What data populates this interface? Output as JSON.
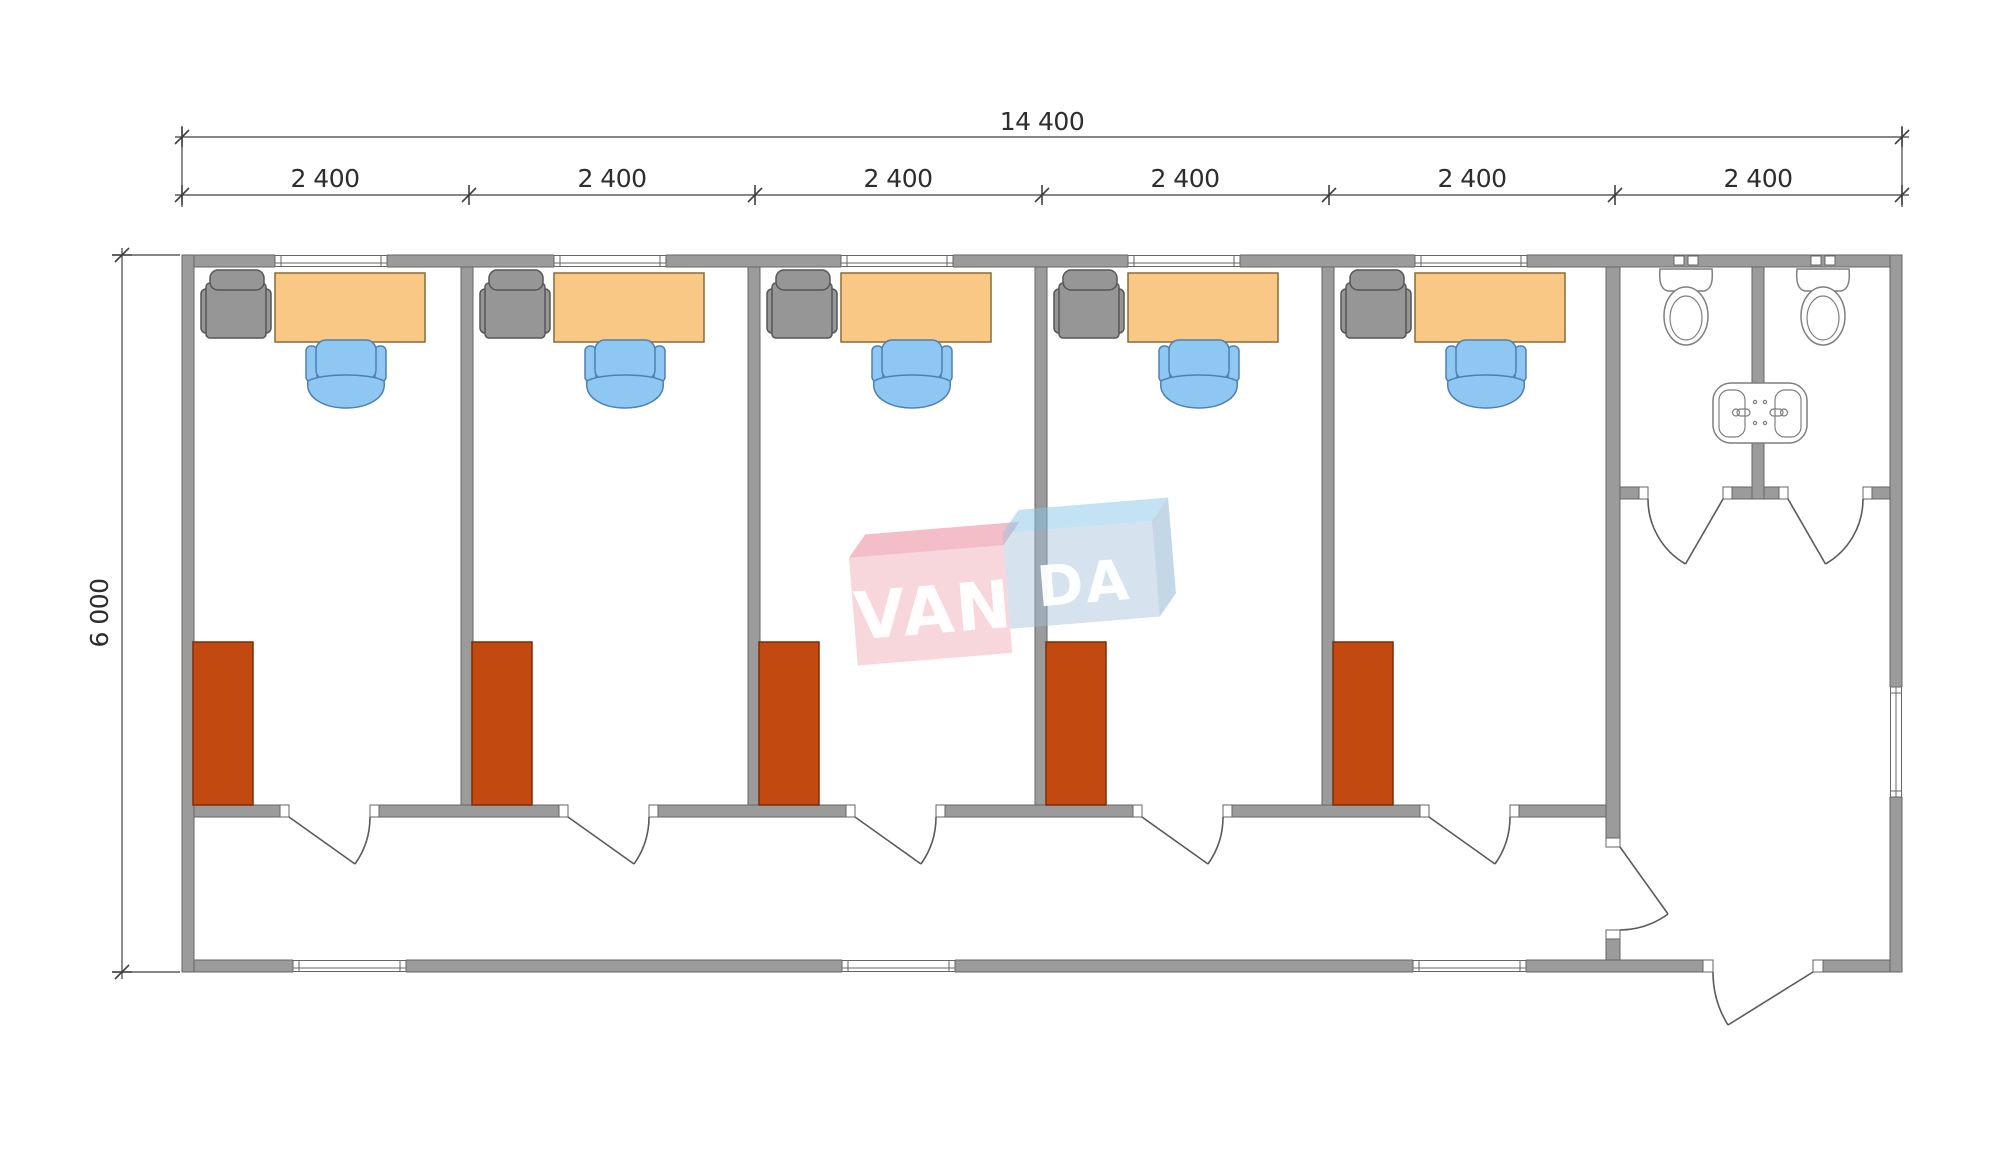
{
  "dimensions": {
    "total_width": "14 400",
    "height": "6 000",
    "modules": [
      "2 400",
      "2 400",
      "2 400",
      "2 400",
      "2 400",
      "2 400"
    ]
  },
  "watermark": {
    "left": "VAN",
    "right": "DA"
  },
  "colors": {
    "wall": "#9b9b9b",
    "wall_edge": "#666666",
    "desk": "#f9c884",
    "desk_edge": "#8a6a34",
    "chair": "#8ec7f2",
    "chair_edge": "#4f81b0",
    "visitor_chair": "#969696",
    "visitor_chair_edge": "#565656",
    "wardrobe": "#c24a10",
    "wardrobe_edge": "#7d2d09",
    "fixture_edge": "#7f7f7f",
    "dim": "#3f3f3f",
    "wm_pink_top": "rgba(231,126,143,0.50)",
    "wm_pink_front": "rgba(238,166,176,0.45)",
    "wm_blue_top": "rgba(136,199,233,0.50)",
    "wm_blue_front": "rgba(164,191,214,0.45)",
    "wm_blue_side": "rgba(148,183,211,0.55)",
    "wm_text": "rgba(255,255,255,0.95)"
  }
}
